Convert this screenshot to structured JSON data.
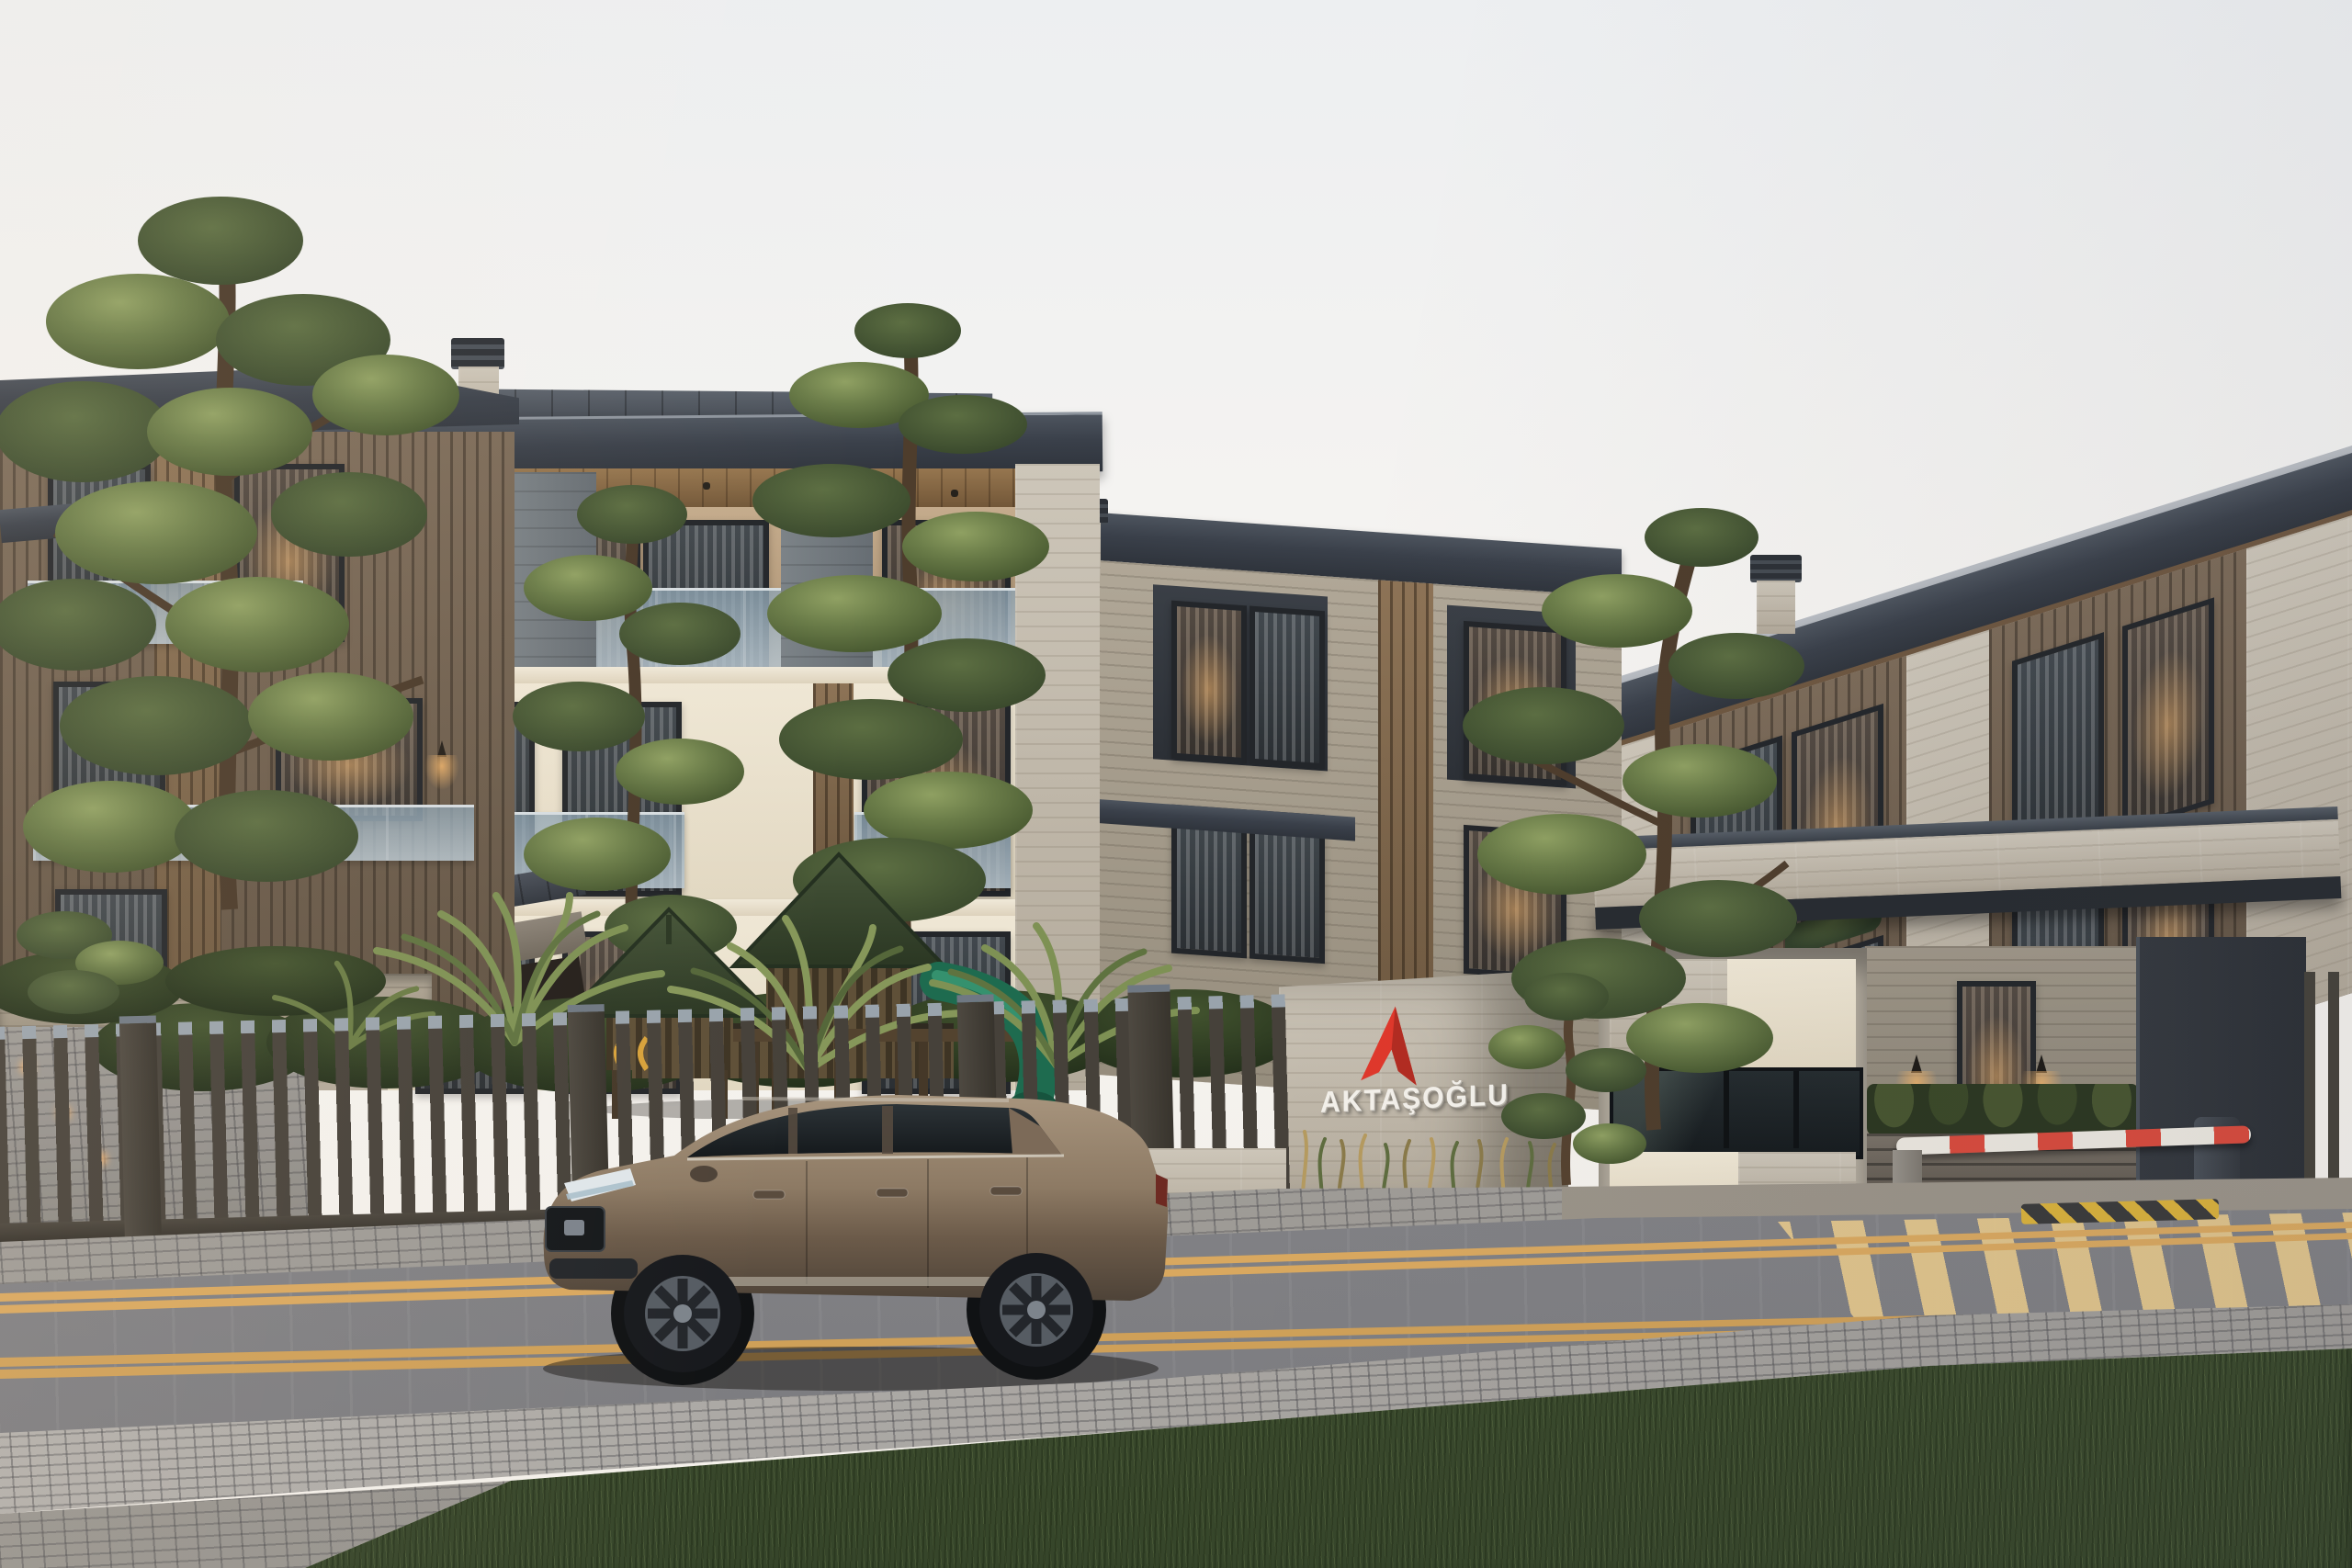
{
  "scene": {
    "type": "architectural-exterior-render",
    "description": "Modern three-storey residential complex with travertine and wood facades, gated entrance with security booth and barrier, children playground, sculpted pines and palms, bronze SUV passing on a wet asphalt road at dusk",
    "sky_color": "#f2f1ee"
  },
  "sign": {
    "brand": "AKTAŞOĞLU",
    "logo": "red-peak-arrow-icon",
    "logo_color": "#df382b",
    "letter_color": "#f3f0ea",
    "wall_material": "travertine"
  },
  "entrance": {
    "canopy_material": "travertine",
    "security_booth": "cream-and-glass kiosk",
    "wall_lamps": 2,
    "barrier": {
      "state": "closed",
      "stripe_colors": [
        "#ebe7df",
        "#d84a3c"
      ]
    },
    "hazard_marking_colors": [
      "#d9b13b",
      "#3a3a3a"
    ]
  },
  "vehicle": {
    "kind": "suv",
    "body_color": "#8a7460",
    "heading": "left"
  },
  "playground": {
    "towers": 2,
    "canopy_color": "#3a452f",
    "slide_color": "#1f6b4f",
    "structure_color": "#5b4a3a"
  },
  "road": {
    "surface": "wet-asphalt",
    "line_color": "#d9a85f",
    "markings": [
      "double-yellow-centerline",
      "double-yellow-lane-line",
      "yellow-crosswalk-stripes",
      "speed-bump-chevrons"
    ]
  },
  "landscape": {
    "fence_color": "#453f38",
    "elements": [
      "pine-trees",
      "palm-shrubs",
      "hedge-rows",
      "ornamental-grasses",
      "topiary",
      "lawn",
      "cobblestone-sidewalk"
    ]
  },
  "palette": {
    "roof": "#3d434d",
    "facade_cream": "#ebe2cf",
    "travertine": "#c2bab0",
    "wood_cladding": "#8a7258",
    "dark_cladding": "#33373d",
    "glass_rail": "#a7b9c4",
    "hedge_green": "#31402a",
    "pine_green": "#5a6b44",
    "grass_green": "#48573a",
    "cobblestone": "#a3a19e",
    "warm_light": "#e8b06c",
    "car_bronze": "#8a7460"
  }
}
